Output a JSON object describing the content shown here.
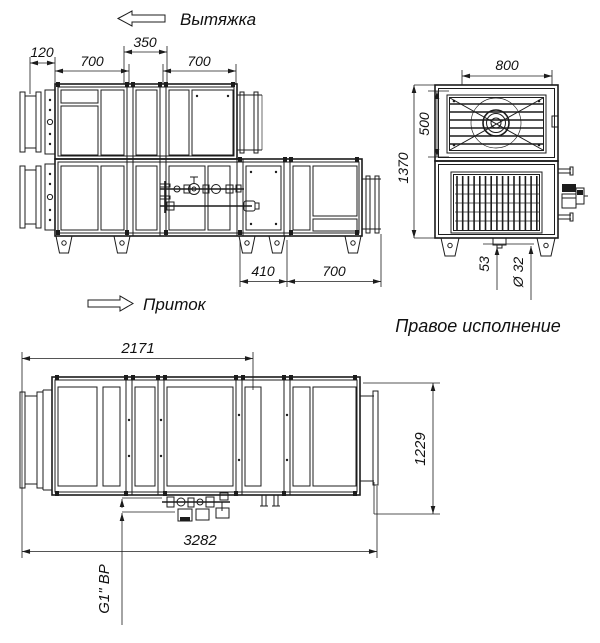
{
  "title": "Правое исполнение",
  "flow": {
    "exhaust": "Вытяжка",
    "supply": "Приток"
  },
  "dims": {
    "d120": "120",
    "d700a": "700",
    "d350": "350",
    "d700b": "700",
    "d410": "410",
    "d700c": "700",
    "d800": "800",
    "d1370": "1370",
    "d500": "500",
    "d53": "53",
    "d32": "Ø 32",
    "d2171": "2171",
    "d1229": "1229",
    "d3282": "3282",
    "thread": "G1\" ВР"
  }
}
